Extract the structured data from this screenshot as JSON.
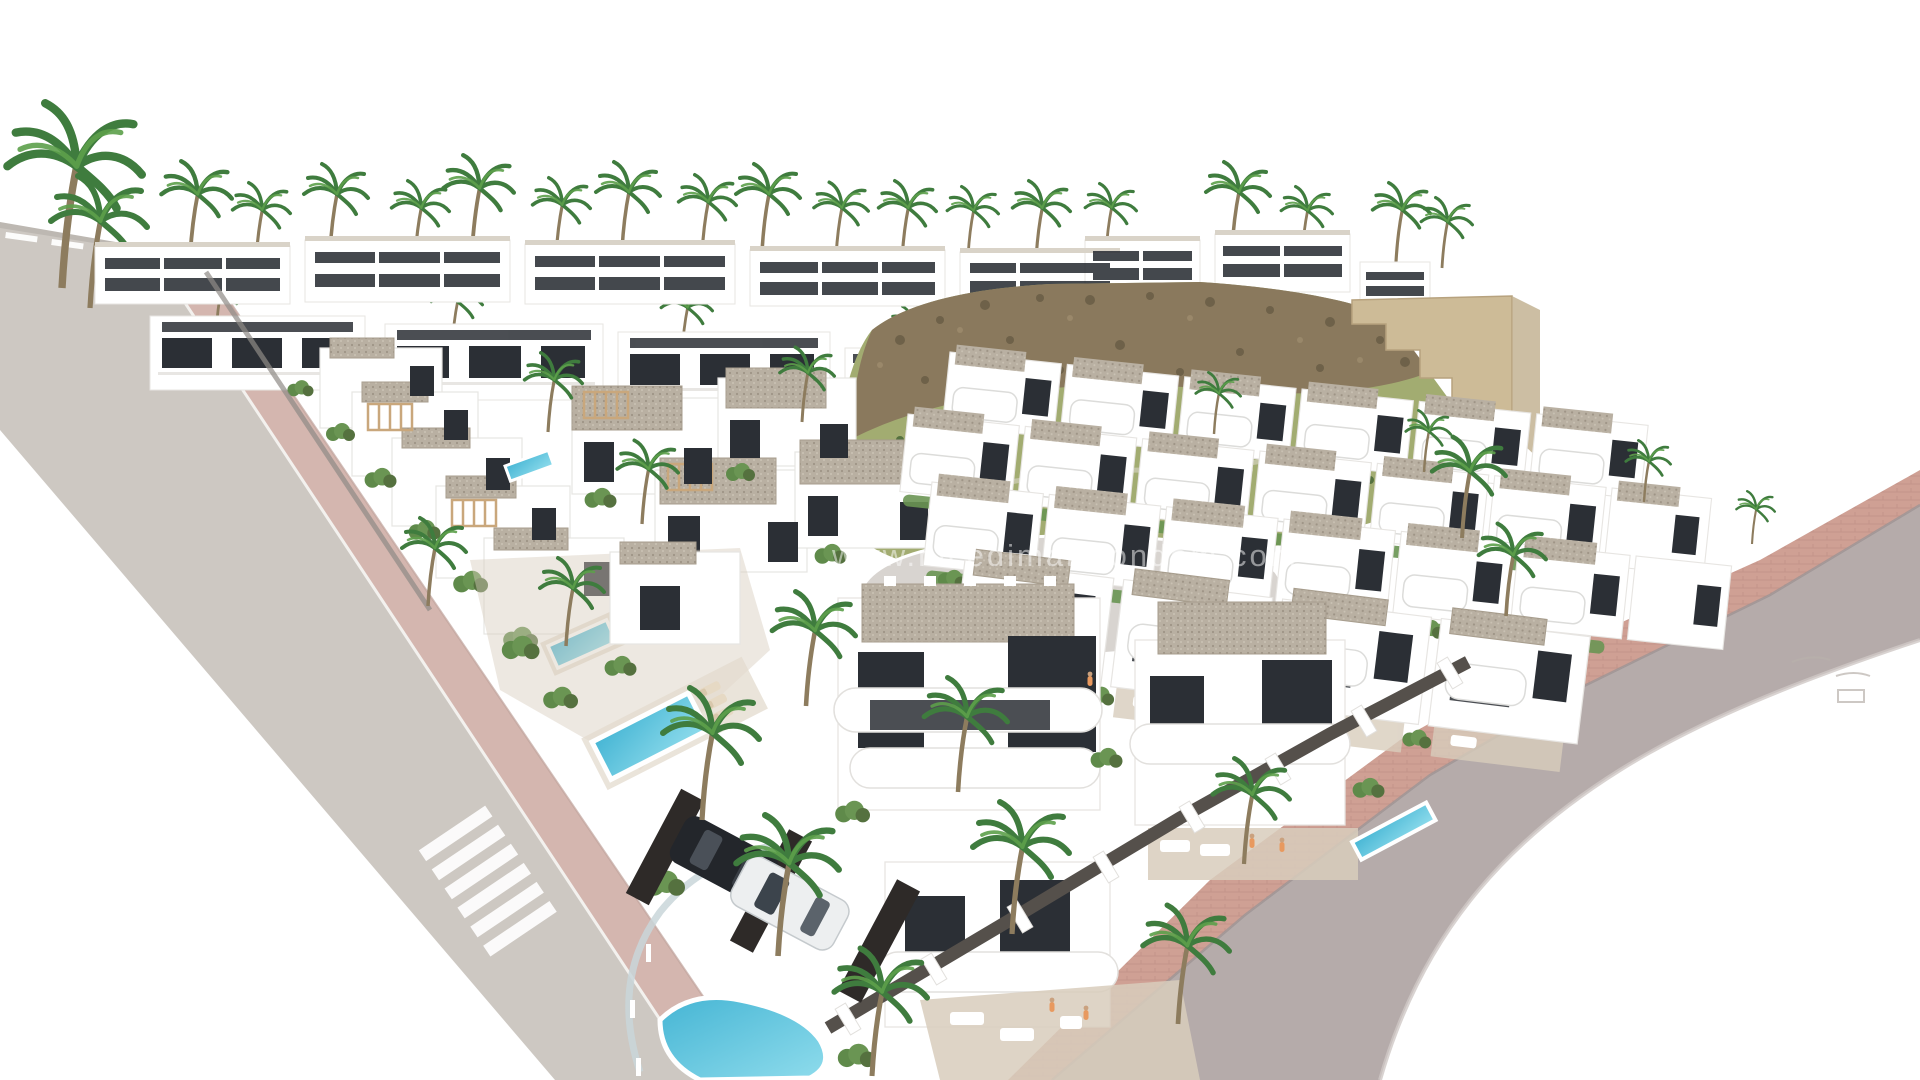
{
  "meta": {
    "type": "architectural-render",
    "description": "Aerial 3D render of a Mediterranean new-build residential development: rows of white modern villas and townhouses with gravel flat roofs, dark glazing, terraces, small swimming pools, palm trees, a rocky scrub-covered hillside with stone retaining walls, a diagonal avenue with zebra crosswalk on the left and a curved embankment road with pink paved sidewalk on the right, on a pure white background.",
    "canvas": {
      "width": 1920,
      "height": 1080
    }
  },
  "watermark": {
    "text": "www.nicedimareiondom.com"
  },
  "colors": {
    "background": "#ffffff",
    "road_gray": "#cdc8c2",
    "road_marking": "#ffffff",
    "sidewalk_pink": "#d4b6af",
    "sidewalk_brick": "#cfa094",
    "embankment_mauve": "#b5abaa",
    "building_white": "#ffffff",
    "building_shade": "#e7e5e2",
    "window_dark": "#2b2f35",
    "roof_gravel": "#b9b0a2",
    "wall_dark": "#55504b",
    "glass_fence": "#c9d6d9",
    "pergola_tan": "#c9a77c",
    "pool_blue": "#45b5d4",
    "pool_light": "#8fdcec",
    "palm_frond": "#3f7c3e",
    "palm_frond_light": "#5da04b",
    "palm_trunk": "#8d7c5e",
    "shrub_green": "#5f8a4a",
    "hedge_green": "#6a9553",
    "hill_grass": "#a2ac71",
    "hill_scrub": "#55713f",
    "hill_rock": "#8a795d",
    "hill_rock_dark": "#6e6149",
    "stone_wall": "#cdbb97",
    "terrace_tan": "#d8cdbc",
    "car_dark": "#23262b",
    "car_white": "#edeff0",
    "person_orange": "#e8995f"
  },
  "scene": {
    "regions": [
      "top-left-access-road",
      "main-avenue",
      "zebra-crosswalk",
      "left-pink-sidewalk",
      "back-apartment-rows",
      "hillside-with-rocks",
      "stone-retaining-wall",
      "cul-de-sac",
      "left-villa-row",
      "central-villa-cluster",
      "right-townhouse-rows",
      "foreground-villas",
      "swimming-pools",
      "parked-cars",
      "perimeter-walls",
      "right-embankment-road",
      "right-brick-sidewalk",
      "palm-trees",
      "watermark"
    ]
  }
}
